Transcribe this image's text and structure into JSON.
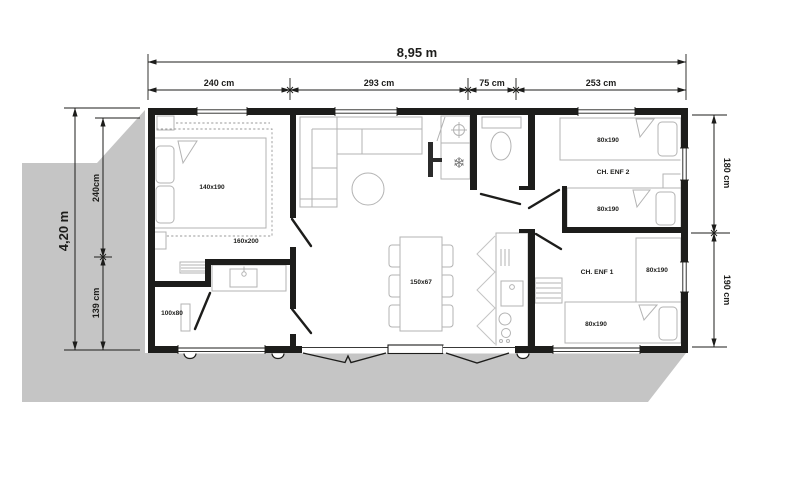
{
  "plan_title": "mobile-home floor plan",
  "colors": {
    "terrain": "#c5c5c5",
    "wall": "#1d1d1b",
    "furniture": "#b3b3b3",
    "tv": "#2b2b2b"
  },
  "dimensions": {
    "total_width": "8,95 m",
    "total_height": "4,20 m",
    "top": [
      "240 cm",
      "293 cm",
      "75 cm",
      "253 cm"
    ],
    "left": [
      "240cm",
      "139 cm"
    ],
    "right": [
      "180 cm",
      "190 cm"
    ]
  },
  "rooms": {
    "master_bedroom": {
      "bed": "140x190",
      "bed_zone": "160x200"
    },
    "shower_room": {
      "size": "100x80"
    },
    "living": {
      "table": "150x67"
    },
    "child_room_2": {
      "name": "CH. ENF 2",
      "bed_top": "80x190",
      "bed_bottom": "80x190"
    },
    "child_room_1": {
      "name": "CH. ENF 1",
      "bed_right": "80x190",
      "bed_bottom": "80x190"
    }
  },
  "icons": {
    "freezer_glyph": "❄"
  }
}
